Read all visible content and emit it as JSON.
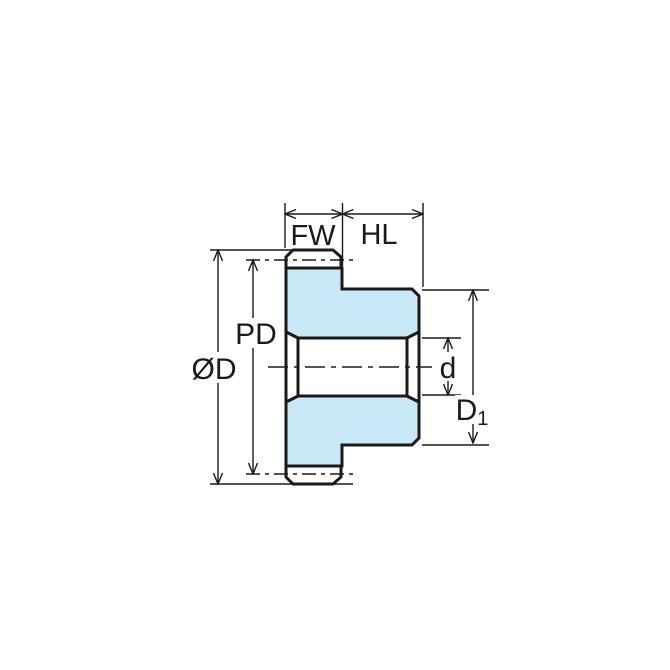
{
  "diagram": {
    "type": "gear-hub-cross-section-dimension-drawing",
    "labels": {
      "face_width": "FW",
      "hub_length": "HL",
      "pitch_diameter": "PD",
      "outer_diameter": "ØD",
      "bore_diameter": "d",
      "hub_diameter_main": "D",
      "hub_diameter_sub": "1"
    },
    "colors": {
      "background": "#ffffff",
      "part_fill": "#c8e8f8",
      "line": "#1a1a1a"
    }
  }
}
